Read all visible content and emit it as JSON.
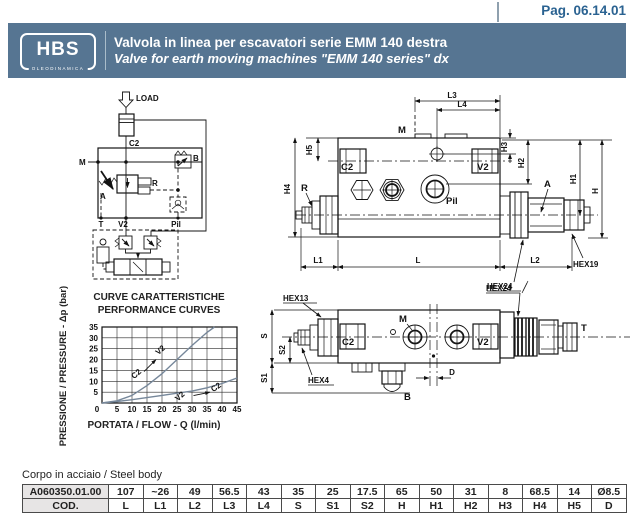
{
  "page": {
    "pag_label": "Pag. 06.14.01"
  },
  "header": {
    "logo": {
      "text": "HBS",
      "subtext": "OLEODINAMICA"
    },
    "title_it": "Valvola in linea per escavatori serie EMM 140 destra",
    "title_en": "Valve for earth moving machines \"EMM 140 series\" dx"
  },
  "schematic": {
    "labels": {
      "load": "LOAD",
      "c2": "C2",
      "m": "M",
      "b": "B",
      "r": "R",
      "a": "A",
      "t": "T",
      "v2": "V2",
      "pil": "Pil"
    }
  },
  "front_view": {
    "labels": {
      "l3": "L3",
      "l4": "L4",
      "m": "M",
      "c2": "C2",
      "v2": "V2",
      "pil": "Pil",
      "r": "R",
      "a": "A",
      "h5": "H5",
      "h4": "H4",
      "h3": "H3",
      "h2": "H2",
      "h1": "H1",
      "h": "H",
      "l1": "L1",
      "l": "L",
      "l2": "L2",
      "hex24": "HEX24",
      "hex19": "HEX19"
    }
  },
  "bottom_view": {
    "labels": {
      "hex24": "HEX24",
      "hex13": "HEX13",
      "hex4": "HEX4",
      "c2": "C2",
      "m": "M",
      "v2": "V2",
      "t": "T",
      "b": "B",
      "d": "D",
      "s": "S",
      "s2": "S2",
      "s1": "S1"
    }
  },
  "chart_data": {
    "type": "line",
    "title": "CURVE CARATTERISTICHE",
    "subtitle": "PERFORMANCE CURVES",
    "xlabel": "PORTATA / FLOW - Q (l/min)",
    "ylabel": "PRESSIONE / PRESSURE - Δp (bar)",
    "xlim": [
      0,
      45
    ],
    "ylim": [
      0,
      35
    ],
    "xticks": [
      0,
      5,
      10,
      15,
      20,
      25,
      30,
      35,
      40,
      45
    ],
    "yticks": [
      5,
      10,
      15,
      20,
      25,
      30,
      35
    ],
    "grid": true,
    "series": [
      {
        "name": "C2 → V2",
        "x": [
          0,
          5,
          10,
          15,
          20,
          25,
          30,
          35,
          37.5
        ],
        "y": [
          0,
          1,
          3.5,
          8,
          13.5,
          20,
          26.5,
          32.5,
          35
        ]
      },
      {
        "name": "V2 → C2",
        "x": [
          0,
          5,
          10,
          15,
          20,
          25,
          30,
          35,
          40,
          45
        ],
        "y": [
          0,
          0.7,
          1.5,
          2.5,
          3.5,
          4.5,
          5.5,
          7,
          9,
          11.5
        ]
      }
    ],
    "annotations": [
      {
        "text": "C2",
        "x": 12,
        "y": 12.5,
        "rot": -42
      },
      {
        "text": "V2",
        "x": 20,
        "y": 23.5,
        "rot": -42
      },
      {
        "text": "V2",
        "x": 26.5,
        "y": 2.2,
        "rot": -42
      },
      {
        "text": "C2",
        "x": 38.5,
        "y": 6.3,
        "rot": -35
      }
    ],
    "arrows": [
      {
        "x1": 14,
        "y1": 14.5,
        "x2": 18,
        "y2": 20
      },
      {
        "x1": 30.5,
        "y1": 3.4,
        "x2": 36,
        "y2": 5
      }
    ]
  },
  "table": {
    "caption": "Corpo in acciaio / Steel body",
    "code": "A060350.01.00",
    "cod_label": "COD.",
    "values": [
      "107",
      "~26",
      "49",
      "56.5",
      "43",
      "35",
      "25",
      "17.5",
      "65",
      "50",
      "31",
      "8",
      "68.5",
      "14",
      "Ø8.5"
    ],
    "labels": [
      "L",
      "L1",
      "L2",
      "L3",
      "L4",
      "S",
      "S1",
      "S2",
      "H",
      "H1",
      "H2",
      "H3",
      "H4",
      "H5",
      "D"
    ]
  },
  "colors": {
    "header_bg": "#567592",
    "page_number": "#2a6291",
    "curve": "#76879a",
    "cell_gray": "#e7e5e5"
  }
}
